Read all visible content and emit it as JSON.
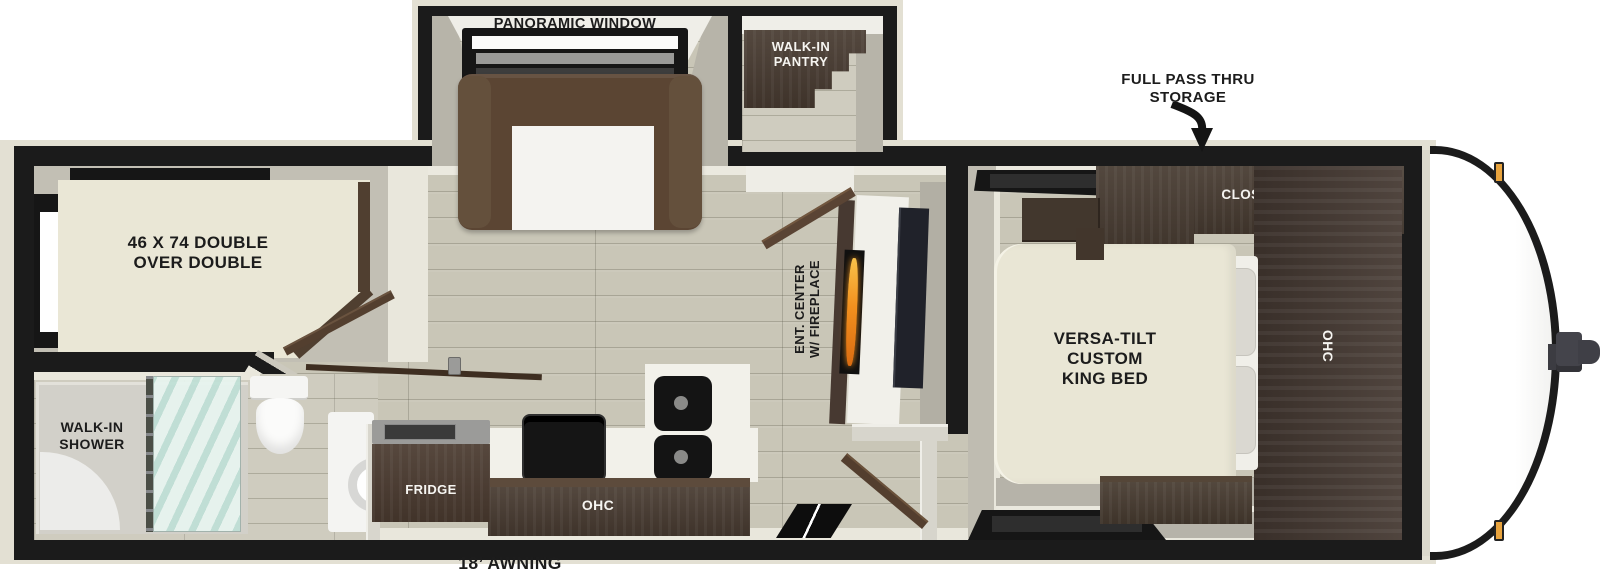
{
  "title": "Travel trailer floor plan",
  "labels": {
    "panoramic_window": "PANORAMIC WINDOW",
    "walk_in_pantry": "WALK-IN\nPANTRY",
    "full_pass_thru_storage": "FULL PASS THRU\nSTORAGE",
    "closet": "CLOSET",
    "bedroom_ohc": "OHC",
    "king_bed": "VERSA-TILT\nCUSTOM\nKING BED",
    "bunk_bed": "46 X 74 DOUBLE\nOVER DOUBLE",
    "walk_in_shower": "WALK-IN\nSHOWER",
    "fridge": "FRIDGE",
    "kitchen_ohc": "OHC",
    "ent_center": "ENT. CENTER\nW/ FIREPLACE",
    "awning": "18’ AWNING"
  },
  "colors": {
    "wall": "#1b1b1b",
    "trim": "#e3e0d3",
    "floor": "#c9c6b7",
    "cabinetry": "#4a3a2f",
    "sofa": "#5b4533",
    "mattress": "#eae7d6",
    "shower_glass": "#bfe0d6",
    "fireplace_flame": "#f2901e",
    "marker_light": "#e8a33d"
  }
}
